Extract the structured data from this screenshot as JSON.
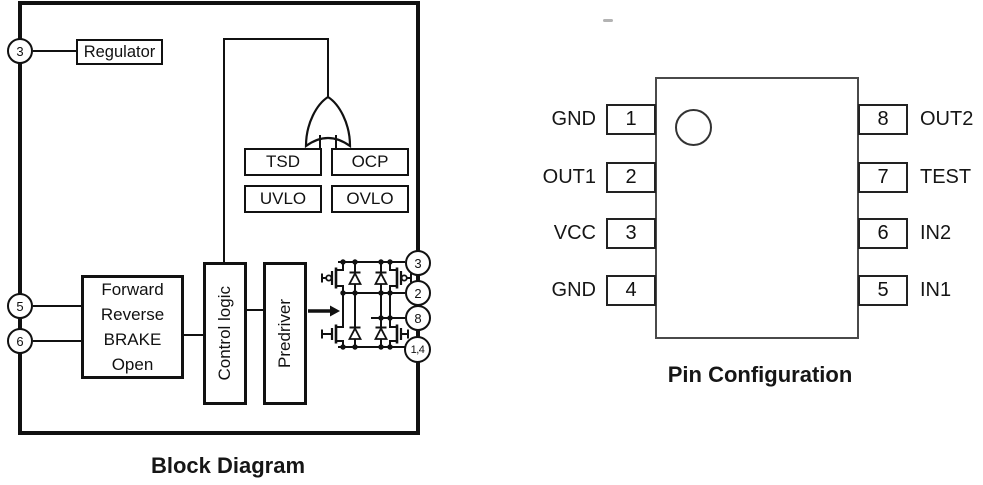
{
  "colors": {
    "ink": "#111111",
    "background": "#ffffff",
    "ic_border": "#4a4a4a"
  },
  "block_diagram": {
    "caption": "Block Diagram",
    "regulator_label": "Regulator",
    "protection_blocks": {
      "tsd": "TSD",
      "ocp": "OCP",
      "uvlo": "UVLO",
      "ovlo": "OVLO"
    },
    "mode_lines": [
      "Forward",
      "Reverse",
      "BRAKE",
      "Open"
    ],
    "control_logic_label": "Control logic",
    "predriver_label": "Predriver",
    "border_pins": {
      "regulator_pin": "3",
      "input_a": "5",
      "input_b": "6",
      "bridge_vcc": "3",
      "bridge_out1": "2",
      "bridge_out2": "8",
      "bridge_gnd": "1,4"
    }
  },
  "pin_configuration": {
    "caption": "Pin Configuration",
    "left_pins": [
      {
        "number": "1",
        "label": "GND"
      },
      {
        "number": "2",
        "label": "OUT1"
      },
      {
        "number": "3",
        "label": "VCC"
      },
      {
        "number": "4",
        "label": "GND"
      }
    ],
    "right_pins": [
      {
        "number": "8",
        "label": "OUT2"
      },
      {
        "number": "7",
        "label": "TEST"
      },
      {
        "number": "6",
        "label": "IN2"
      },
      {
        "number": "5",
        "label": "IN1"
      }
    ]
  }
}
